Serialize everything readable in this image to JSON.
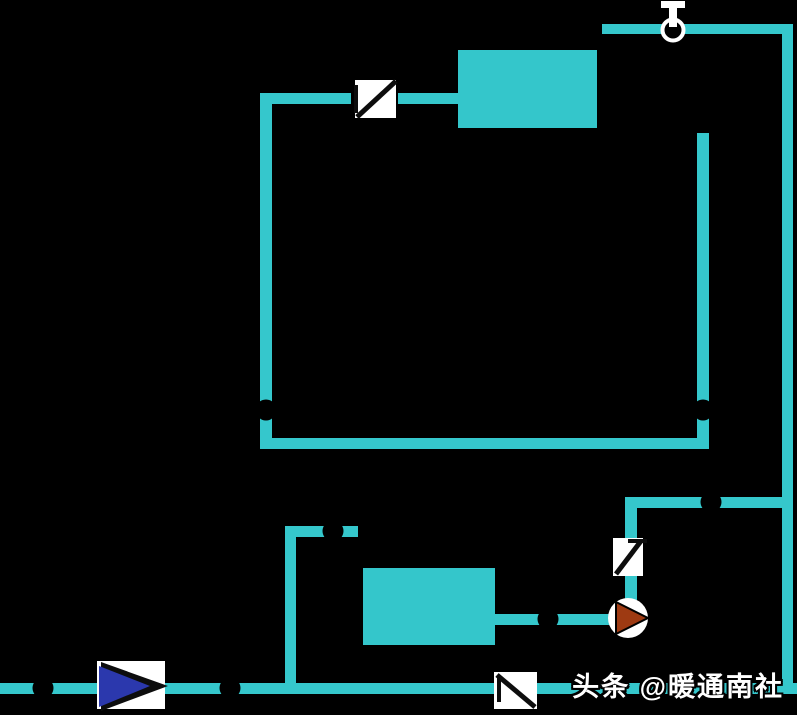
{
  "watermark": {
    "text": "头条 @暖通南社"
  },
  "colors": {
    "background": "#000000",
    "pipe": "#35c7cc",
    "equipment": "#34c6cb",
    "valve_body": "#ffffff",
    "valve_mark": "#0d0d0d",
    "pump_body": "#ffffff",
    "pump_rotor": "#9e3a12",
    "direction_fill": "#2b38ad",
    "junction_dot": "#000000",
    "vent_ring": "#ffffff",
    "vent_fill": "#000000"
  },
  "legend": {
    "check_valve": "check-valve-icon",
    "pump": "pump-icon",
    "air_vent": "auto-air-vent-icon",
    "flow_direction_valve": "directional-valve-icon",
    "junction": "junction-dot",
    "equipment_box": "equipment-box"
  }
}
